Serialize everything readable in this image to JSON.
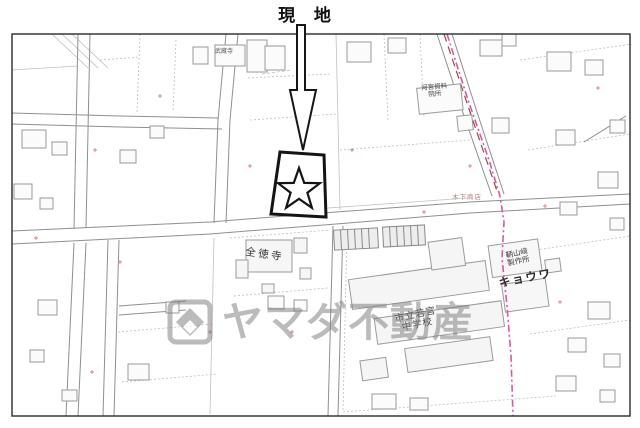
{
  "site_marker": {
    "label": "現 地"
  },
  "map_labels": {
    "temple_small": "武蔵寺",
    "facility": {
      "line1": "河宮資料",
      "line2": "院所"
    },
    "shop": "木下商店",
    "temple_main": "全徳寺",
    "school": {
      "line1": "市立若宮",
      "line2": "中学校"
    },
    "factory": {
      "line1": "鞆山﨑",
      "line2": "製作所"
    },
    "company": "キョウワ"
  },
  "watermark": {
    "text": "ヤマダ不動産",
    "logo_icon": "yamada-diamond-logo"
  },
  "colors": {
    "boundary_line": "#d957a8",
    "road_centerline": "#9c4a42",
    "map_line": "#8f8f8f",
    "parcel_line": "#bfbfbf",
    "target_outline": "#141414",
    "watermark": "#7e7e7e",
    "survey_mark": "#cc7a6e"
  }
}
